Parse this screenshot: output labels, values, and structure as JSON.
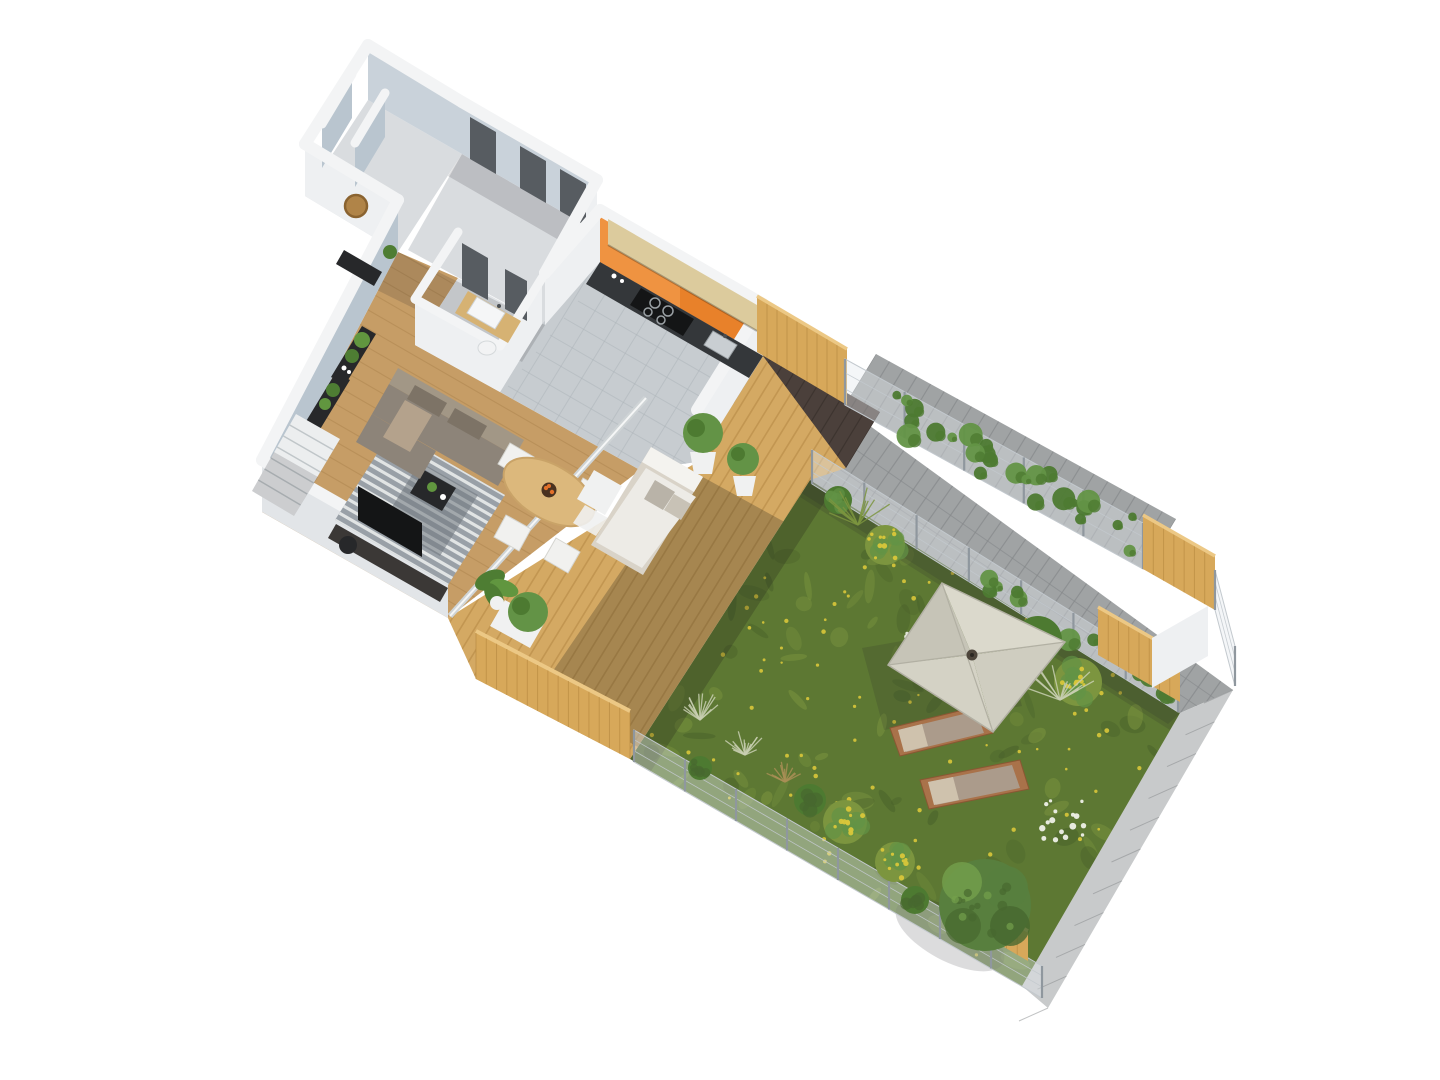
{
  "canvas": {
    "width": 1440,
    "height": 1080,
    "background": "#ffffff"
  },
  "scene": {
    "type": "isometric-3d-floor-plan-rendering",
    "view": "top-down-axonometric",
    "building": {
      "rooms": [
        "utility-rooms",
        "corridor-with-doors",
        "entry-hall",
        "bathroom",
        "kitchen",
        "living-dining-room",
        "staircase"
      ],
      "accent_wall": "orange-painted-wall"
    },
    "interior_furniture": [
      "corner-sofa",
      "striped-area-rug",
      "coffee-table",
      "oval-dining-table",
      "dining-chairs-x4",
      "fruit-bowl",
      "tv-cabinet",
      "round-wall-mirror",
      "console-table",
      "black-shelving-units",
      "potted-plants",
      "kitchen-counter-with-cooktop",
      "kitchen-sink",
      "upper-cabinets",
      "bathroom-vanity-with-sink",
      "toilet"
    ],
    "outdoor": {
      "areas": [
        "wooden-deck",
        "garden-lawn",
        "paver-walkway",
        "neighbor-paver-terrace"
      ],
      "furniture": [
        "outdoor-sofa",
        "square-parasol",
        "sun-loungers-x2",
        "white-planters-x2",
        "planter-shrub"
      ],
      "landscape": [
        "lawn-with-yellow-flowers",
        "flowering-shrubs",
        "ornamental-grasses",
        "round-tree",
        "climbing-ivy",
        "white-wildflowers"
      ],
      "boundaries": [
        "wire-mesh-fence",
        "wooden-privacy-screens",
        "low-deck-fence",
        "concrete-curb"
      ]
    }
  },
  "palette": {
    "white-bg": "#ffffff",
    "wall-top": "#f3f4f5",
    "white-face": "#eef0f2",
    "white-face-dim": "#e2e5e8",
    "bluewall": "#b9c5cf",
    "bluewall-light": "#c9d2da",
    "floor": "#d9dcdf",
    "tile": "#c7ccd0",
    "tile-line": "#aeb5ba",
    "wood-floor": "#c69d66",
    "wood-line": "#a8814b",
    "door": "#575c61",
    "orange": "#e8812a",
    "orange-light": "#f29a4a",
    "black": "#27282a",
    "tv-unit": "#3b3836",
    "sofa": "#8d8479",
    "sofa-back": "#a29786",
    "cushion": "#7d7366",
    "throw": "#b4a28c",
    "rug": "#99a0a7",
    "rug-stripe": "#e9ebec",
    "rug-dark": "#70777e",
    "table-wood": "#dcb87c",
    "table-edge": "#c9a368",
    "chair": "#f1f1ef",
    "chair-line": "#d5d5d0",
    "fruit": "#e2702a",
    "bowl": "#4a3220",
    "deck": "#d4a963",
    "deck-gap": "#b08340",
    "pavers-dark": "#4b403b",
    "pavers-dark-line": "#352d29",
    "walkway": "#a0a3a4",
    "walkway-line": "#85888a",
    "curb": "#c8cacb",
    "mesh": "rgba(228,233,237,0.4)",
    "mesh-line": "#c3c9ce",
    "post": "#8f979e",
    "woodscreen": "#d7a85a",
    "woodscreen-line": "#b5873e",
    "woodscreen-top": "#ecc885",
    "ivy": "#4d7a31",
    "ivy-light": "#639346",
    "grass": "#5d7833",
    "grass-dark": "#48602a",
    "grass-light": "#7c953f",
    "tuft-silver": "#c9cfb2",
    "tuft-brown": "#a98f56",
    "flower-yellow": "#d9c63a",
    "flower-white": "#eef0e8",
    "tree": "#587f3e",
    "tree-dark": "#47682f",
    "tree-light": "#74a04c",
    "umb1": "#dbd9cc",
    "umb2": "#cfcdc0",
    "umb3": "#d4d2c5",
    "umb4": "#c6c4b7",
    "umb-rib": "#b2b0a3",
    "umb-hub": "#4e463c",
    "lounger-wood": "#a9724a",
    "lounger-wood-dark": "#8a5733",
    "lounger-cushion": "#ab9b8b",
    "lounger-head": "#cfc2ad",
    "counter": "#34373a",
    "cooktop": "#141516",
    "ring": "#9aa0a4",
    "sink-steel": "#c9ced2",
    "upper-cab": "#dccb9d",
    "vanity": "#d6b273",
    "sink-white": "#f5f6f7",
    "toilet": "#f2f3f4",
    "mirror": "#b08448",
    "mirror-rim": "#8a6330",
    "stairs": "#eceeef",
    "stair-line": "#c0c6c9",
    "glass": "#cfd4d6",
    "planter-white": "#f0f1f1",
    "couch-cushion": "#edebe6",
    "couch-back": "#f4f3ef",
    "pillow": "#b9b3a8",
    "shadow": "rgba(40,40,45,0.16)",
    "shadow-strong": "rgba(35,33,28,0.26)",
    "leaf": "#4e7d33",
    "leaf-light": "#61963f"
  }
}
